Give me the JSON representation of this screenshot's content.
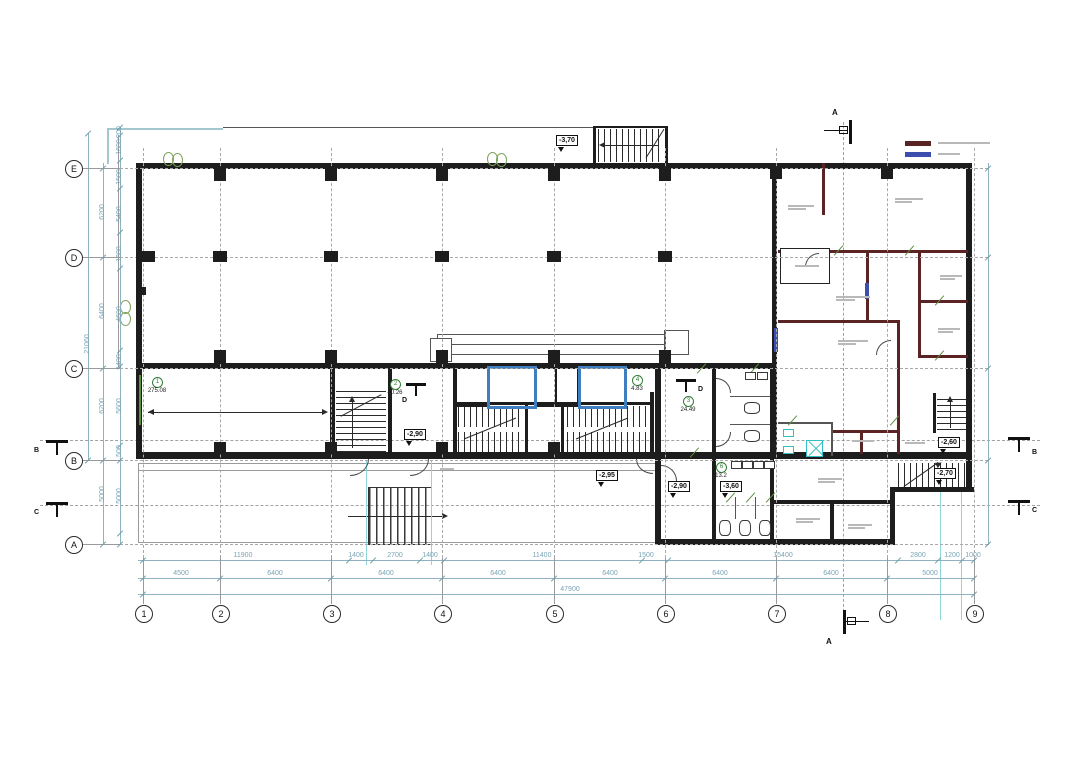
{
  "grid": {
    "cols": [
      "1",
      "2",
      "3",
      "4",
      "5",
      "6",
      "7",
      "8",
      "9"
    ],
    "rows": [
      "E",
      "D",
      "C",
      "B",
      "A"
    ]
  },
  "dimensions": {
    "bottom_row1": [
      "11900",
      "1400",
      "2700",
      "1400",
      "11400",
      "1500",
      "15400",
      "2800",
      "1200",
      "1000"
    ],
    "bottom_row2": [
      "4500",
      "6400",
      "6400",
      "6400",
      "6400",
      "6400",
      "6400",
      "5000"
    ],
    "bottom_total": "47900",
    "left_inner": [
      "200",
      "1600",
      "1500",
      "5400",
      "1600",
      "4600",
      "1400",
      "5600",
      "500",
      "5000"
    ],
    "left_outer": [
      "6200",
      "6400",
      "6200",
      "5000"
    ],
    "left_total": "21060"
  },
  "elevations": [
    "-3,70",
    "-2,90",
    "-2,95",
    "-2,90",
    "-3,60",
    "-2,60",
    "-2,70"
  ],
  "rooms": [
    {
      "num": "1",
      "area": "275.08"
    },
    {
      "num": "2",
      "area": "40.26"
    },
    {
      "num": "3",
      "area": "24.49"
    },
    {
      "num": "4",
      "area": "4.83"
    },
    {
      "num": "6",
      "area": "13.2"
    }
  ],
  "sections": {
    "a": "A",
    "b": "B",
    "c": "C",
    "d": "D"
  },
  "legend": {
    "items": [
      {
        "name": "existing-masonry-wall",
        "color": "#5a2424"
      },
      {
        "name": "new-partition-wall",
        "color": "#3d4fae"
      }
    ]
  },
  "colors": {
    "wall": "#1d1d1d",
    "masonry": "#5a2424",
    "partition": "#3d4fae",
    "dimension": "#7aa4b4",
    "fixture": "#2fbfc4",
    "room_marker": "#2e7d32",
    "elevator": "#3f7fbf"
  }
}
